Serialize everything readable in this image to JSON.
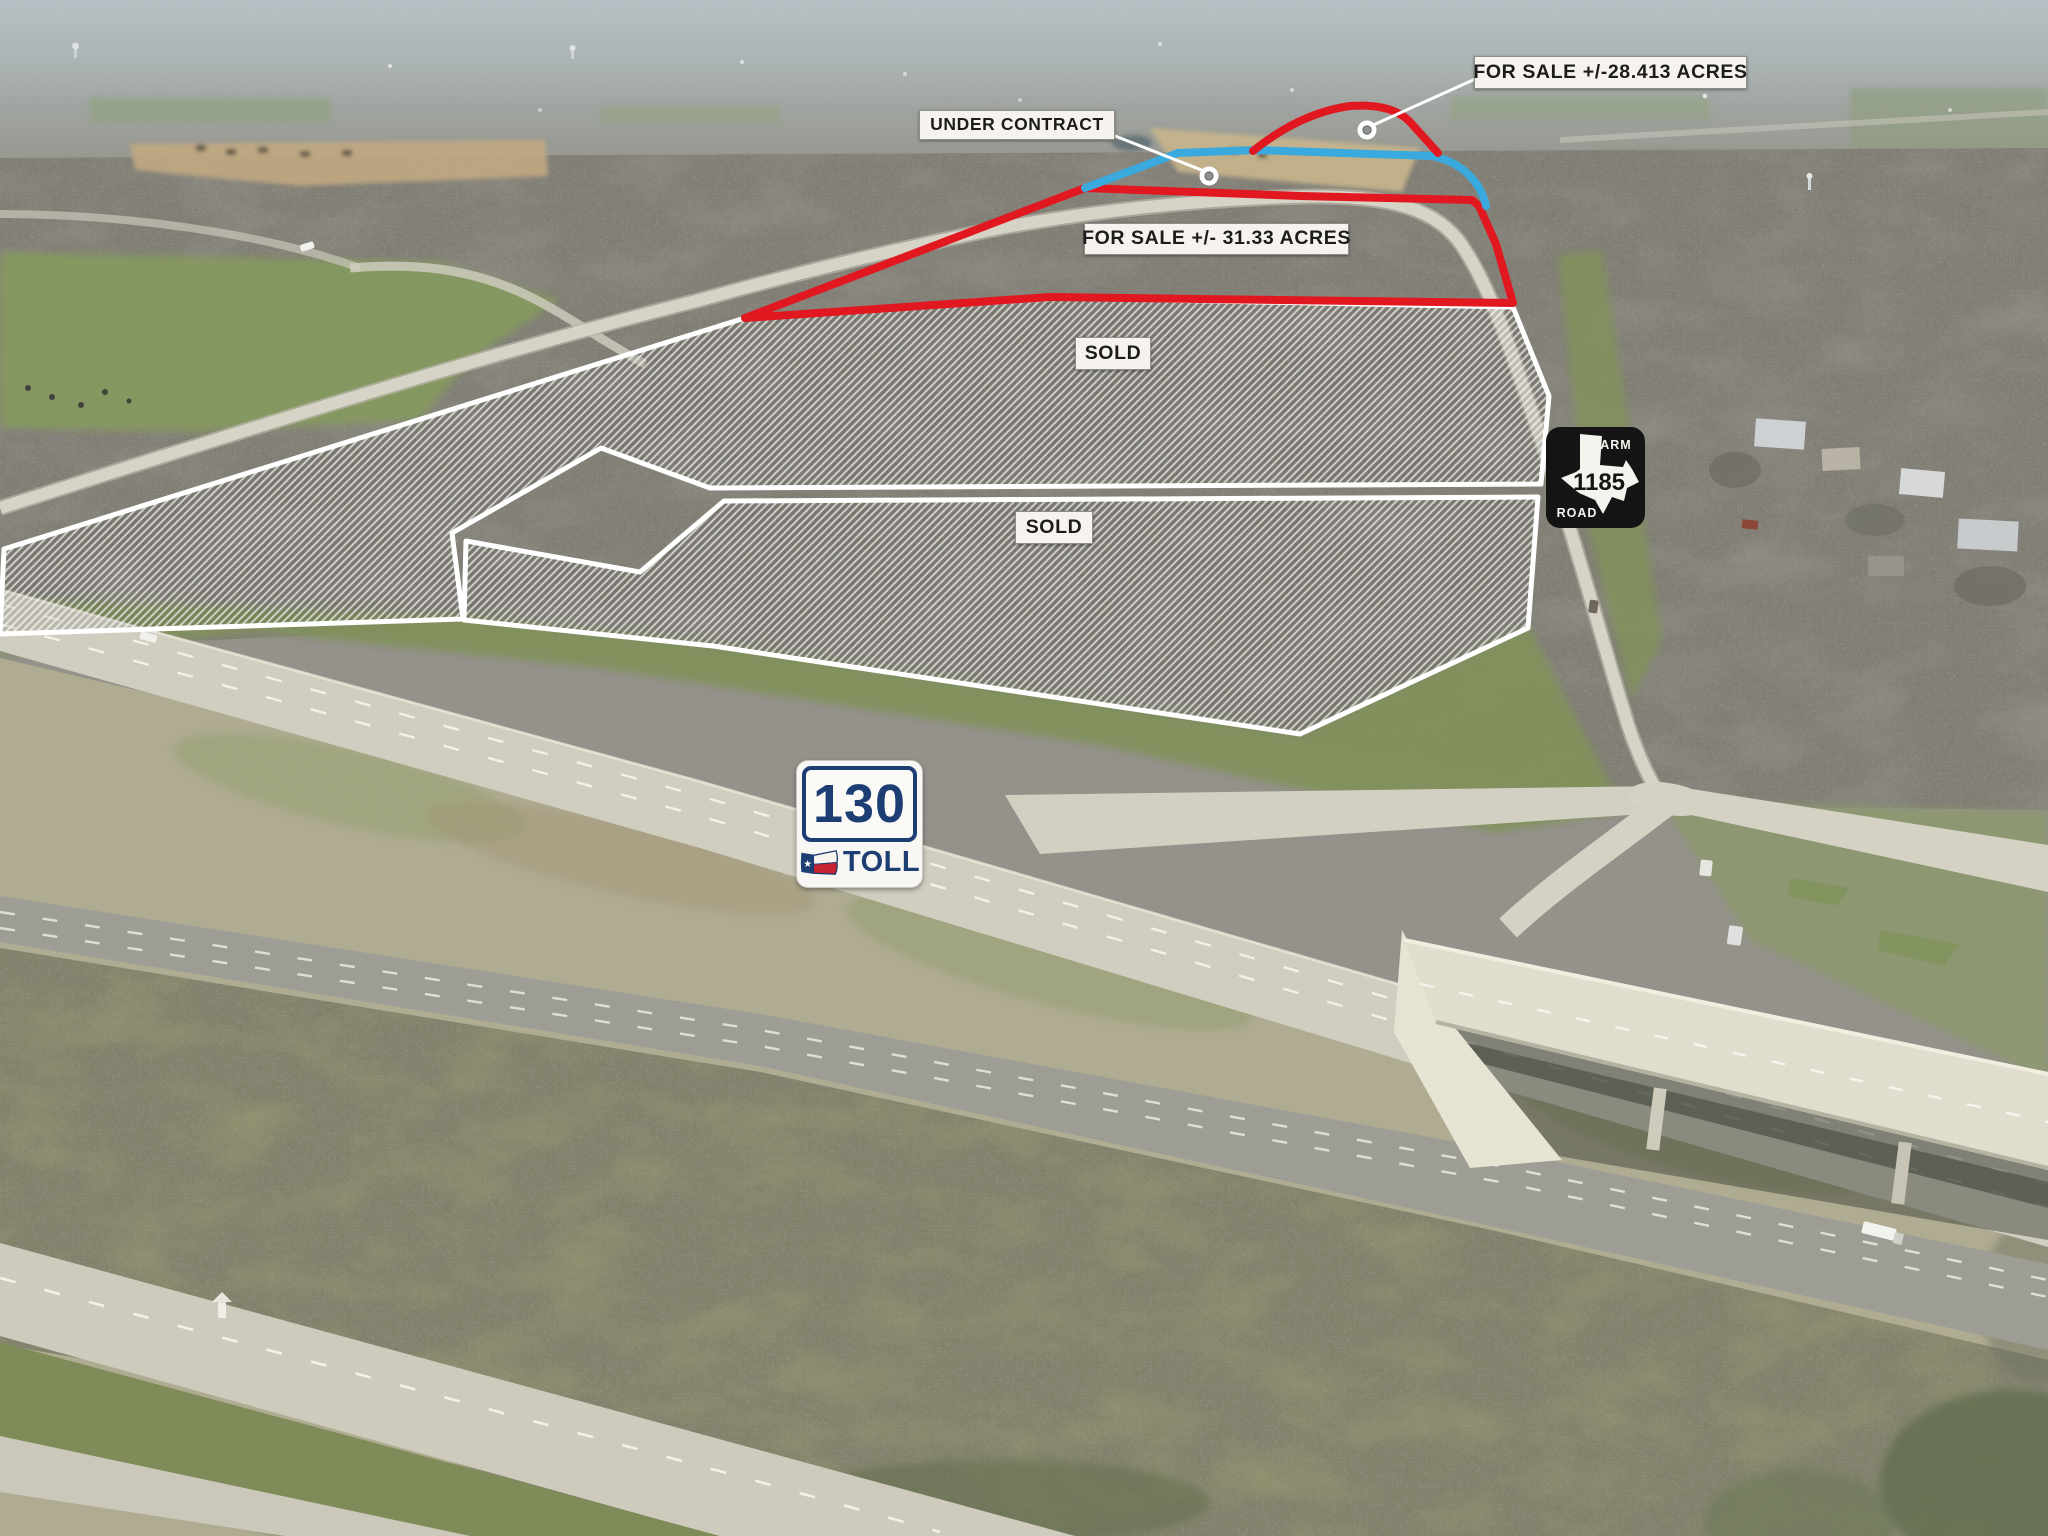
{
  "annotations": {
    "for_sale_small": {
      "text": "FOR SALE +/-28.413 ACRES"
    },
    "under_contract": {
      "text": "UNDER CONTRACT"
    },
    "for_sale_large": {
      "text": "FOR SALE +/- 31.33 ACRES"
    },
    "sold_upper": {
      "text": "SOLD"
    },
    "sold_lower": {
      "text": "SOLD"
    }
  },
  "shields": {
    "farm_road": {
      "type_top": "FARM",
      "number": "1185",
      "type_bottom": "ROAD"
    },
    "toll_130": {
      "number": "130",
      "word": "TOLL",
      "star": "★"
    }
  },
  "colors": {
    "boundary_red": "#e11820",
    "boundary_blue": "#3aa9dd",
    "boundary_white": "#ffffff",
    "label_bg": "#f6f3ee",
    "label_text": "#1c1c1a",
    "shield_navy": "#1d3e73",
    "shield_black": "#141414",
    "flag_red": "#c62433"
  }
}
